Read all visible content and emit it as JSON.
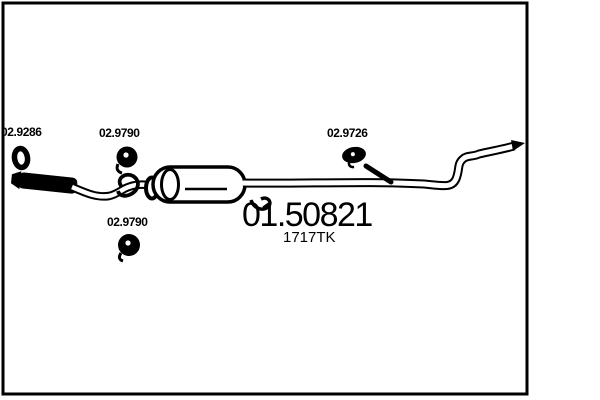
{
  "page": {
    "kind": "exhaust-parts-catalog-drawing",
    "paper_color": "#ffffff",
    "ink_color": "#000000"
  },
  "diagram": {
    "labels": [
      {
        "name": "gasket-part",
        "text": "02.9286"
      },
      {
        "name": "clamp-front-part",
        "text": "02.9790"
      },
      {
        "name": "clamp-rear-part",
        "text": "02.9726"
      },
      {
        "name": "clamp-bottom-part",
        "text": "02.9790"
      }
    ],
    "part_number": "01.50821",
    "type_code": "1717TK",
    "components": [
      "gasket-ring",
      "flex-pipe",
      "front-pipe",
      "hanger-hook",
      "muffler",
      "tail-pipe",
      "hanger-rod",
      "clamp",
      "frame-border"
    ]
  }
}
